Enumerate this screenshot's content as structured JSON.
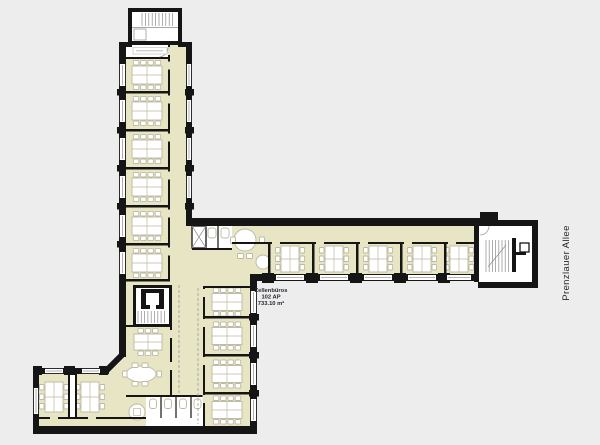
{
  "plan": {
    "street_label": "Prenzlauer Allee",
    "area_label": {
      "title": "Zellenbüros",
      "workplaces": "102 AP",
      "area": "733.10 m²"
    }
  },
  "colors": {
    "background": "#ededed",
    "wall": "#151515",
    "room": "#e8e5c4",
    "core": "#ffffff",
    "furniture": "#ffffff",
    "furniture-stroke": "#bcb9a2",
    "stair-line": "#8a8a8a",
    "glass-line": "#9b9b9b",
    "dash-line": "#9a9a9a",
    "text": "#26262e"
  }
}
